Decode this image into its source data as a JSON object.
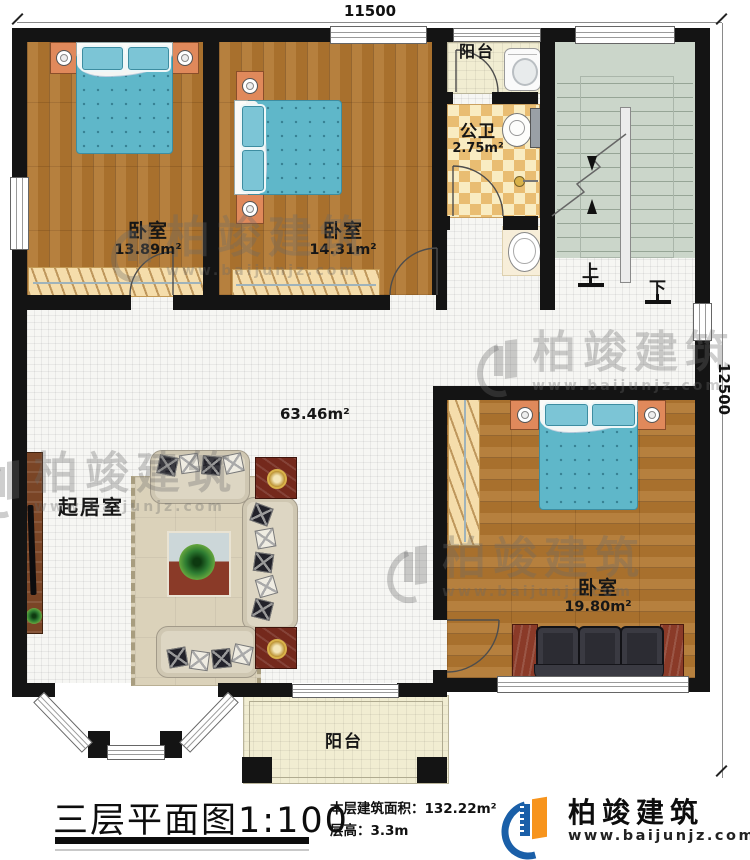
{
  "dimensions": {
    "width_label": "11500",
    "height_label": "12500"
  },
  "rooms": {
    "bedroom1": {
      "name": "卧室",
      "area": "13.89m²"
    },
    "bedroom2": {
      "name": "卧室",
      "area": "14.31m²"
    },
    "bedroom3": {
      "name": "卧室",
      "area": "19.80m²"
    },
    "bathroom": {
      "name": "公卫",
      "area": "2.75m²"
    },
    "living_room": {
      "name": "起居室",
      "area": "63.46m²"
    },
    "balcony_top": {
      "name": "阳台"
    },
    "balcony_bottom": {
      "name": "阳台"
    }
  },
  "stairs": {
    "up_label": "上",
    "down_label": "下"
  },
  "title_block": {
    "title": "三层平面图",
    "scale": "1:100",
    "floor_area_label": "本层建筑面积：",
    "floor_area_value": "132.22m²",
    "floor_height_label": "层高：",
    "floor_height_value": "3.3m"
  },
  "brand": {
    "name": "柏竣建筑",
    "website": "www.baijunjz.com"
  },
  "watermark": {
    "name": "柏竣建筑",
    "website": "www.baijunjz.com"
  },
  "colors": {
    "wall": "#141414",
    "wood_floor": "#b1762f",
    "bed_blue": "#5fb7c9",
    "checker_tan": "#e9bd72",
    "stair_green": "#cbd6ca",
    "brand_blue": "#1a5fa8",
    "brand_orange": "#f7941d"
  }
}
